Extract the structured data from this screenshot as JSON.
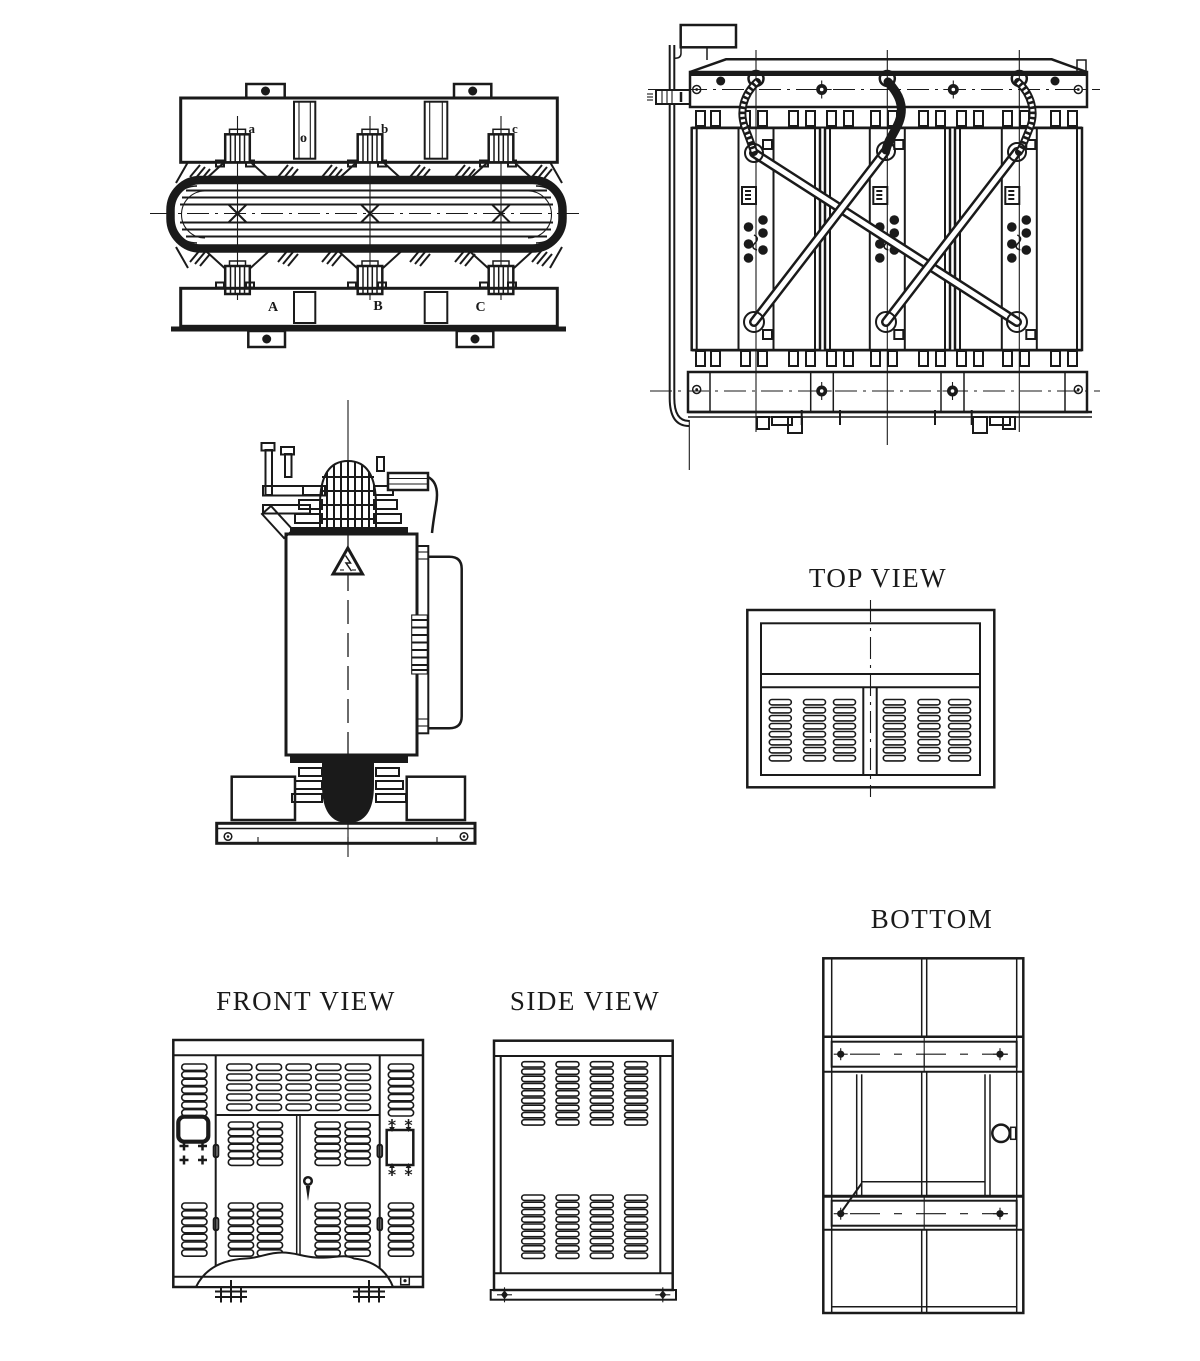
{
  "colors": {
    "ink": "#1a1a1a",
    "paper": "#ffffff"
  },
  "titles": {
    "top_view": "TOP VIEW",
    "bottom": "BOTTOM",
    "front_view": "FRONT VIEW",
    "side_view": "SIDE VIEW"
  },
  "core_assembly_plan_view": {
    "lv_terminals": {
      "a": "a",
      "b": "b",
      "c": "c"
    },
    "neutral": "o",
    "hv_terminals": {
      "A": "A",
      "B": "B",
      "C": "C"
    }
  }
}
